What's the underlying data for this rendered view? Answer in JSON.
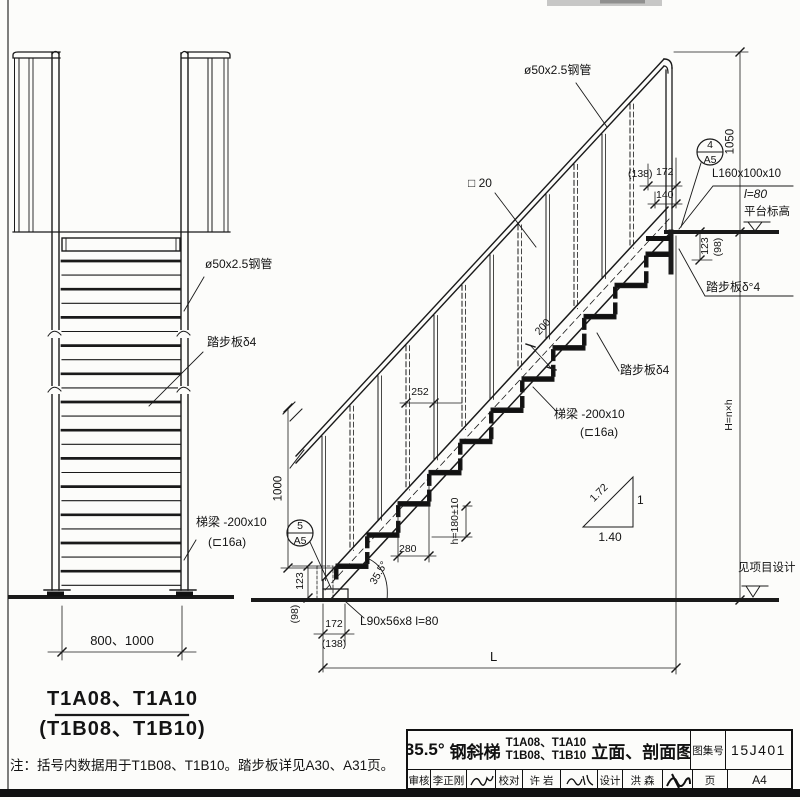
{
  "left_view": {
    "pipe": "ø50x2.5钢管",
    "tread": "踏步板δ4",
    "stringer1": "梯梁 -200x10",
    "stringer2": "(⊏16a)",
    "width_dim": "800、1000",
    "caption1": "T1A08、T1A10",
    "caption2": "(T1B08、T1B10)"
  },
  "right_view": {
    "pipe": "ø50x2.5钢管",
    "baluster": "□ 20",
    "tread_top": "踏步板δ°4",
    "tread_mid": "踏步板δ4",
    "stringer1": "梯梁 -200x10",
    "stringer2": "(⊏16a)",
    "angle_conn1": "L160x100x10",
    "angle_conn2": "l=80",
    "platform_level": "平台标高",
    "ground_level": "见项目设计",
    "base_angle": "L90x56x8  l=80"
  },
  "dims": {
    "d1050": "1050",
    "d138t": "(138)",
    "d172t": "172",
    "d140": "140",
    "d123t": "123",
    "d98t": "(98)",
    "d252": "252",
    "d200": "200",
    "d280": "280",
    "dh": "h=180±10",
    "angle": "35.5°",
    "d1000": "1000",
    "d123b": "123",
    "d98b": "(98)",
    "d172b": "172",
    "d138b": "(138)",
    "dL": "L",
    "dH": "H=n×h",
    "slope_hyp": "1.72",
    "slope_v": "1",
    "slope_run": "1.40"
  },
  "details": {
    "top_num": "4",
    "top_sheet": "A5",
    "bottom_num": "5",
    "bottom_sheet": "A5"
  },
  "note": "注：括号内数据用于T1B08、T1B10。踏步板详见A30、A31页。",
  "title_block": {
    "angle": "35.5°",
    "name": "钢斜梯",
    "models1": "T1A08、T1A10",
    "models2": "T1B08、T1B10",
    "suffix": "立面、剖面图",
    "atlas_label": "图集号",
    "atlas_no": "15J401",
    "page_label": "页",
    "page_no": "A4",
    "check_label": "审核",
    "check_name": "李正刚",
    "proof_label": "校对",
    "proof_name": "许 岩",
    "design_label": "设计",
    "design_name": "洪 森"
  }
}
